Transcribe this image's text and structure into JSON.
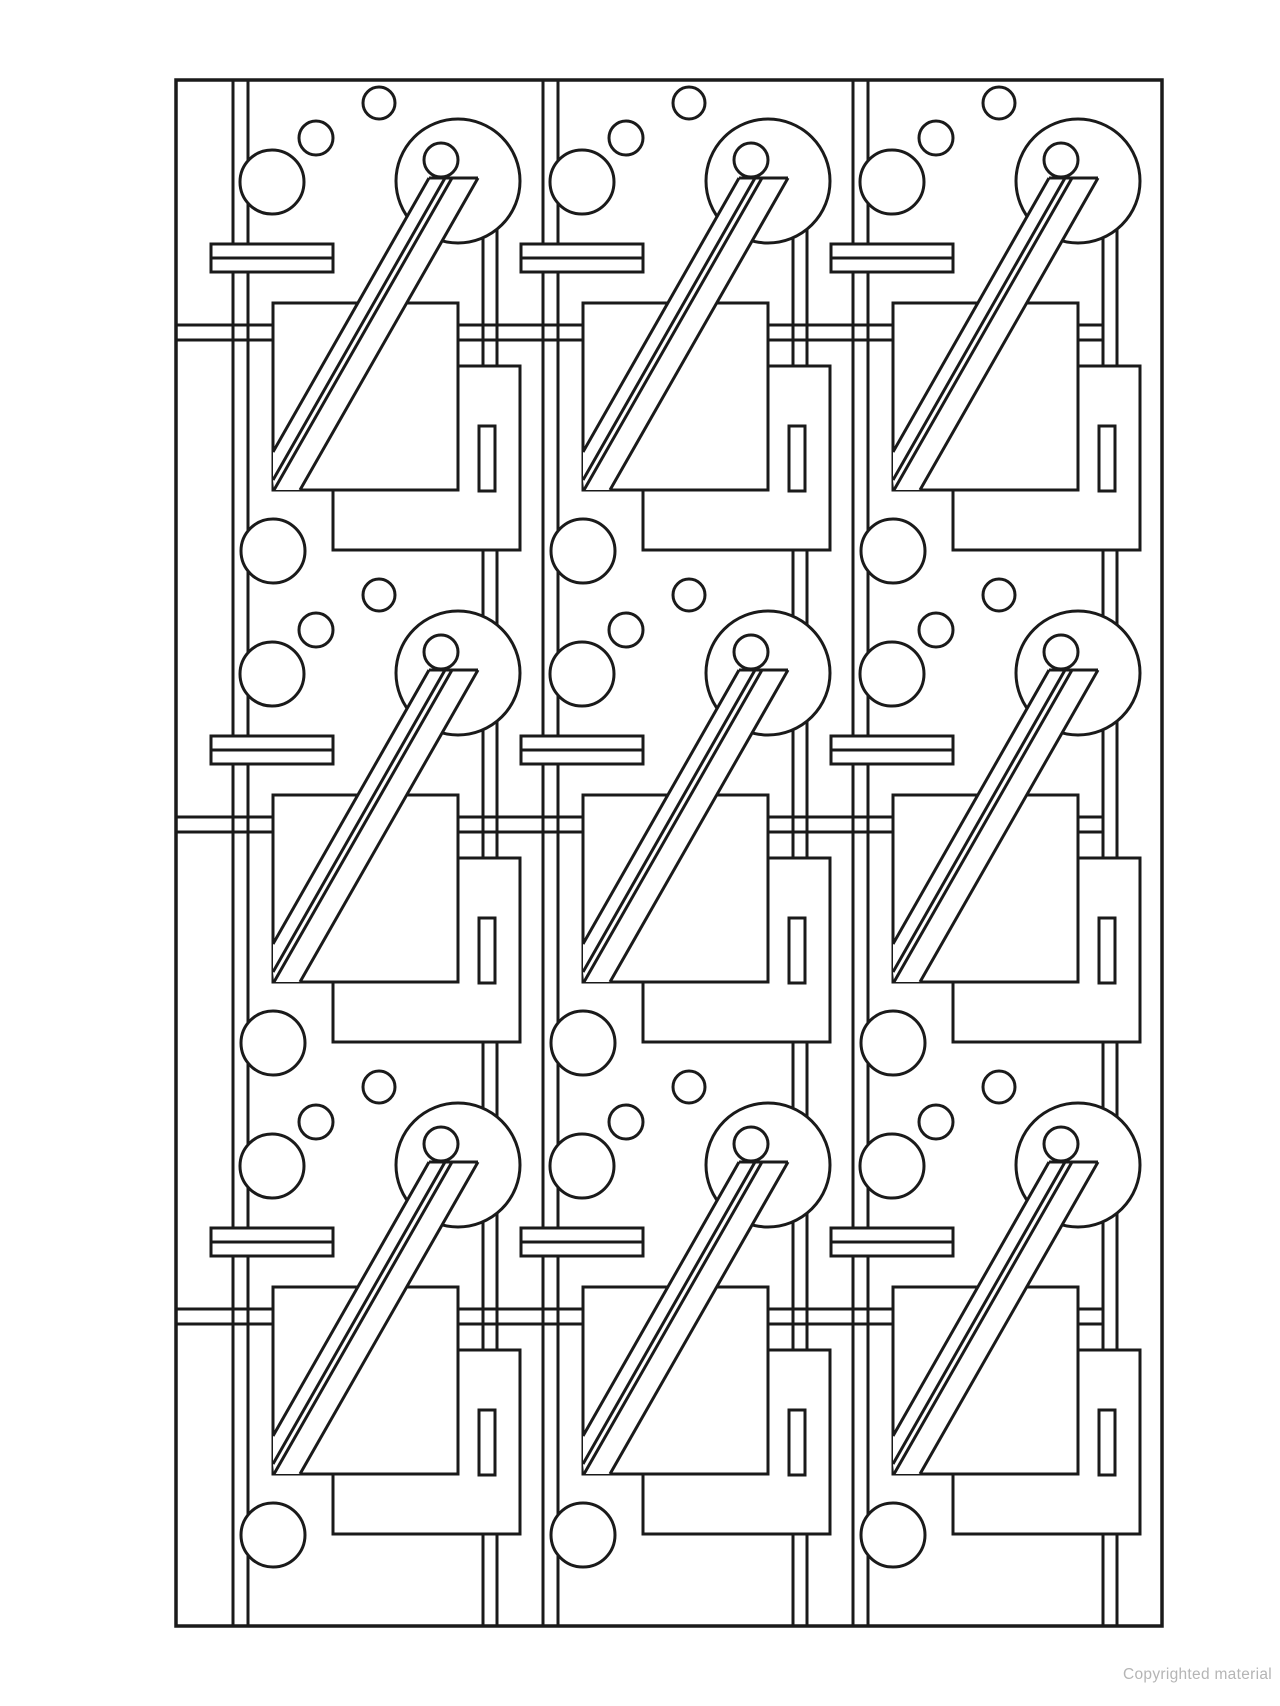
{
  "page": {
    "background": "#ffffff",
    "watermark": "Copyrighted material",
    "watermark_color": "#b5b5b5"
  },
  "artwork": {
    "description": "Abstract geometric line-art pattern: 3x3 repeated motif of circles, squares, rails and a diagonal beam",
    "canvas": {
      "width": 1280,
      "height": 1706
    },
    "stroke": {
      "color": "#1a1a1a",
      "width": 3
    },
    "frame": {
      "x": 176,
      "y": 80,
      "w": 986,
      "h": 1546
    },
    "grid": {
      "cols": 3,
      "rows": 3,
      "col_pitch": 310,
      "row_pitch": 492
    },
    "rails": {
      "vertical_x": [
        233,
        248
      ],
      "horizontal_y": [
        325,
        340
      ],
      "horizontal_x_start": 176,
      "horizontal_x_end": 1103
    },
    "tile": {
      "scatter_circles": [
        {
          "name": "medium-upper-circle",
          "cx": 272,
          "cy": 182,
          "r": 32
        },
        {
          "name": "small-circle",
          "cx": 316,
          "cy": 138,
          "r": 17
        },
        {
          "name": "tiny-top-circle",
          "cx": 379,
          "cy": 103,
          "r": 16
        },
        {
          "name": "medium-lower-circle",
          "cx": 273,
          "cy": 551,
          "r": 32
        }
      ],
      "big_circle": {
        "cx": 458,
        "cy": 181,
        "r": 62
      },
      "inner_circle": {
        "cx": 441,
        "cy": 160,
        "r": 17
      },
      "hanger": {
        "x": [
          483,
          497
        ],
        "upper_top_y": [
          238,
          229
        ],
        "upper_bottom_y": 375,
        "lower_top_y": 545,
        "lower_bottom_y": 680,
        "last_row_bottom_y": 642
      },
      "square_back": {
        "x": 333,
        "y": 366,
        "w": 187,
        "h": 184
      },
      "slot": {
        "x": 479,
        "y": 426,
        "w": 16,
        "h": 65
      },
      "square_front": {
        "x": 273,
        "y": 303,
        "w": 185,
        "h": 187
      },
      "bar": {
        "x": 211,
        "y": 244,
        "w": 122,
        "h": 28,
        "mid_y": 258
      },
      "beam": {
        "fill_poly": [
          [
            429,
            178
          ],
          [
            478,
            178
          ],
          [
            300,
            490
          ],
          [
            274,
            490
          ],
          [
            273,
            480
          ],
          [
            273,
            452
          ]
        ],
        "lines": [
          [
            429,
            178,
            478,
            178
          ],
          [
            429,
            178,
            273,
            452
          ],
          [
            445,
            178,
            273,
            480
          ],
          [
            452,
            178,
            274,
            490
          ],
          [
            478,
            178,
            300,
            490
          ]
        ]
      }
    }
  }
}
